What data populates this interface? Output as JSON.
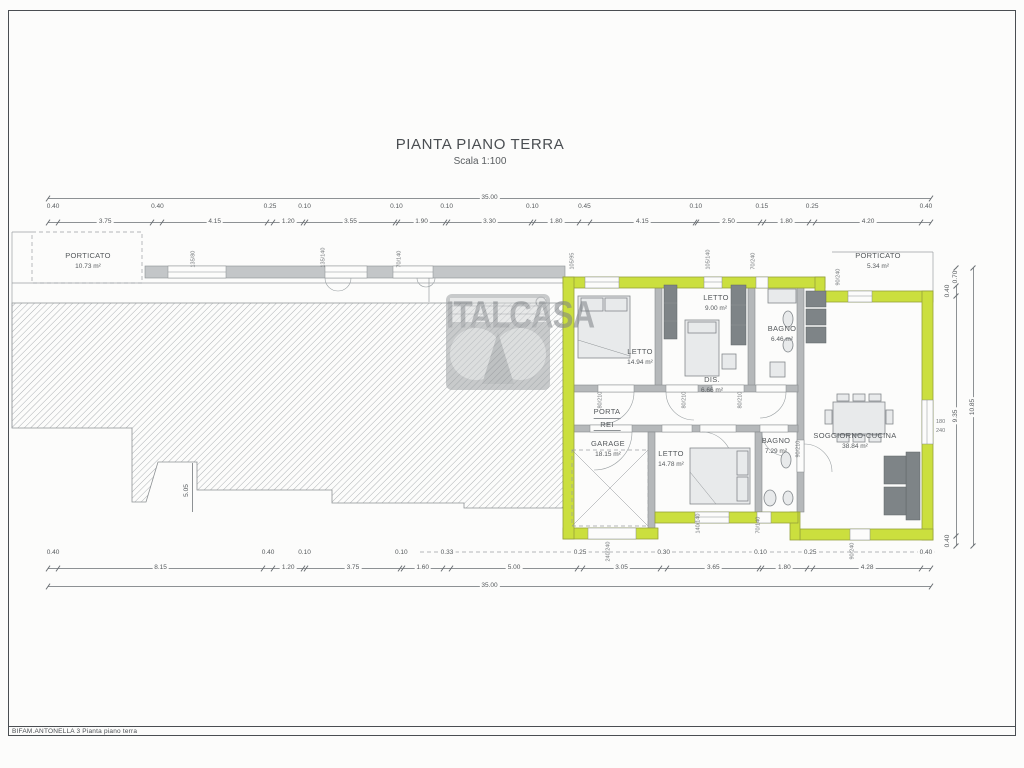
{
  "title": {
    "main": "PIANTA PIANO TERRA",
    "scale": "Scala 1:100"
  },
  "watermark": {
    "brand": "ITALCASA"
  },
  "footer": {
    "label": "BIFAM.ANTONELLA 3 Pianta piano terra"
  },
  "colors": {
    "wall_highlight": "#cbdf3e",
    "wall_gray": "#b5b8ba",
    "line": "#8d9194",
    "paper": "#fcfcfb"
  },
  "dimensions": {
    "top": {
      "total": "35.00",
      "segments": [
        "0.40",
        "3.75",
        "0.40",
        "4.15",
        "0.25",
        "1.20",
        "0.10",
        "3.55",
        "0.10",
        "1.90",
        "0.10",
        "3.30",
        "0.10",
        "1.80",
        "0.45",
        "4.15",
        "0.10",
        "2.50",
        "0.15",
        "1.80",
        "0.25",
        "4.20",
        "0.40"
      ]
    },
    "bottom": {
      "total": "35.00",
      "segments": [
        "0.40",
        "8.15",
        "0.40",
        "1.20",
        "0.10",
        "3.75",
        "0.10",
        "1.60",
        "0.33",
        "5.00",
        "0.25",
        "3.05",
        "0.30",
        "3.65",
        "0.10",
        "1.80",
        "0.25",
        "4.28",
        "0.40"
      ]
    },
    "right": {
      "total": "10.85",
      "segments": [
        "0.70",
        "0.40",
        "9.35",
        "0.40"
      ]
    },
    "left_wing_depth": "5.05"
  },
  "rooms": {
    "porticato_left": {
      "name": "PORTICATO",
      "area": "10.73 m²"
    },
    "letto_nw": {
      "name": "LETTO",
      "area": "14.94 m²"
    },
    "letto_n": {
      "name": "LETTO",
      "area": "9.00 m²"
    },
    "bagno_n": {
      "name": "BAGNO",
      "area": "6.46 m²"
    },
    "disimpegno": {
      "name": "DIS.",
      "area": "6.66 m²"
    },
    "porta_rei": {
      "line1": "PORTA",
      "line2": "REI"
    },
    "garage": {
      "name": "GARAGE",
      "area": "18.15 m²"
    },
    "letto_s": {
      "name": "LETTO",
      "area": "14.78 m²"
    },
    "bagno_s": {
      "name": "BAGNO",
      "area": "7.29 m²"
    },
    "soggiorno": {
      "name": "SOGGIORNO-CUCINA",
      "area": "38.84 m²"
    },
    "porticato_right": {
      "name": "PORTICATO",
      "area": "5.34 m²"
    }
  },
  "opening_labels": {
    "top_wall": [
      "135/80",
      "135/140",
      "70/140",
      "105/95",
      "105/140",
      "70/240"
    ],
    "porch": "90/240",
    "bottom_wall": [
      "240/240",
      "140/140",
      "70/140",
      "90/240"
    ],
    "right_wall": [
      "180",
      "240"
    ],
    "doors": [
      "80/210",
      "80/210",
      "80/210",
      "90/210"
    ]
  }
}
